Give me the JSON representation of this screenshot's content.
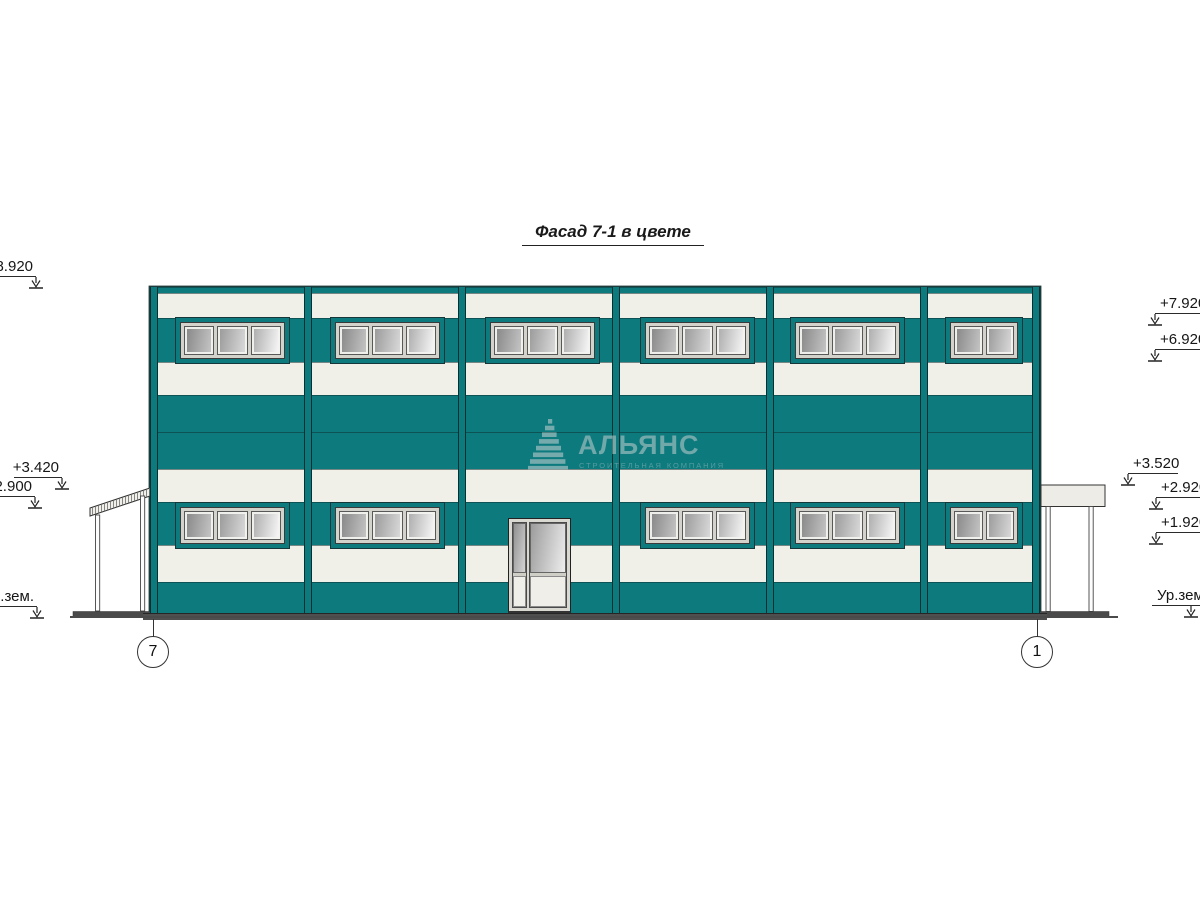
{
  "title": "Фасад 7-1 в цвете",
  "watermark": {
    "logo": "triangle-sail",
    "text": "АЛЬЯНС",
    "subtext": "СТРОИТЕЛЬНАЯ КОМПАНИЯ"
  },
  "colors": {
    "facade_teal": "#0d7a7e",
    "facade_white": "#f0efe8",
    "outline": "#1e3a3a",
    "glass_dark": "#8a8a8a",
    "glass_light": "#f5f5f5",
    "plinth_gray": "#4a4a4a"
  },
  "elevations": {
    "left": [
      {
        "label": "+8.920"
      },
      {
        "label": "+3.420"
      },
      {
        "label": "+2.900"
      },
      {
        "label": "Ур.зем."
      }
    ],
    "right": [
      {
        "label": "+7.920"
      },
      {
        "label": "+6.920"
      },
      {
        "label": "+3.520"
      },
      {
        "label": "+2.920"
      },
      {
        "label": "+1.920"
      },
      {
        "label": "Ур.зем"
      }
    ]
  },
  "grid_axes": [
    {
      "label": "7"
    },
    {
      "label": "1"
    }
  ],
  "facade": {
    "bays": 6,
    "window_rows": 2,
    "windows_top_row": 6,
    "windows_bottom_row": 5,
    "panes_per_window": 3,
    "panes_last_bay": 2,
    "door_bay": 3
  }
}
